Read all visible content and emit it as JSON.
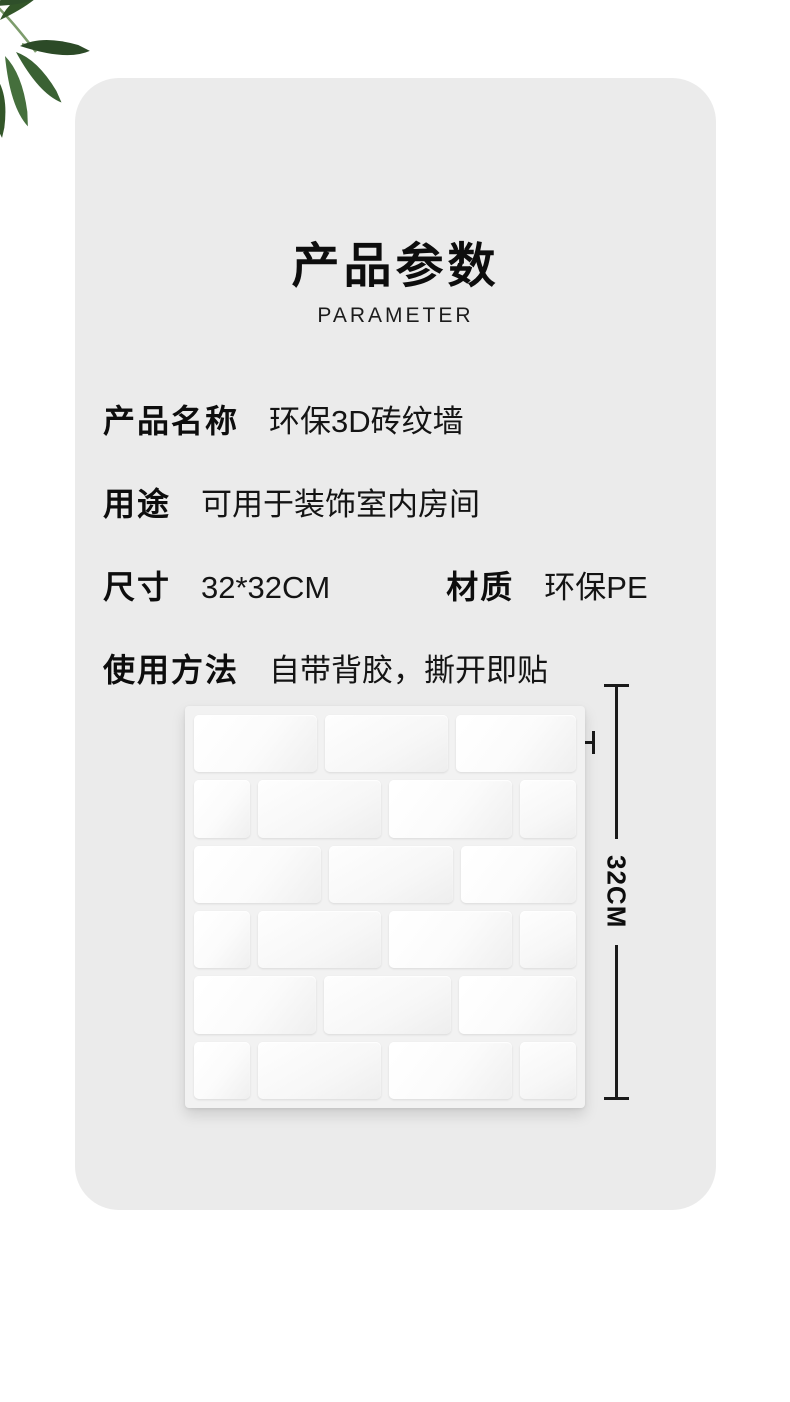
{
  "header": {
    "title": "产品参数",
    "subtitle": "PARAMETER"
  },
  "specs": {
    "rows": [
      {
        "pairs": [
          {
            "label": "产品名称",
            "value": "环保3D砖纹墙"
          }
        ]
      },
      {
        "pairs": [
          {
            "label": "用途",
            "value": "可用于装饰室内房间"
          }
        ]
      },
      {
        "pairs": [
          {
            "label": "尺寸",
            "value": "32*32CM"
          },
          {
            "label": "材质",
            "value": "环保PE"
          }
        ]
      },
      {
        "pairs": [
          {
            "label": "使用方法",
            "value": "自带背胶，撕开即贴"
          }
        ]
      }
    ]
  },
  "diagram": {
    "width_label": "32CM",
    "height_label": "32CM",
    "panel_description": "white 3D brick texture wall panel",
    "brick_rows": [
      {
        "widths": [
          1,
          1,
          0.97
        ]
      },
      {
        "widths": [
          0.45,
          1,
          1,
          0.45
        ]
      },
      {
        "widths": [
          1.05,
          1.02,
          0.95
        ]
      },
      {
        "widths": [
          0.45,
          1,
          1,
          0.45
        ]
      },
      {
        "widths": [
          1,
          1.04,
          0.96
        ]
      },
      {
        "widths": [
          0.45,
          1,
          1,
          0.45
        ]
      }
    ]
  },
  "colors": {
    "card_background": "#ebebeb",
    "page_background": "#ffffff",
    "text": "#111111",
    "dimension_line": "#1a1a1a",
    "brick_white": "#fdfdfd",
    "leaf_green_dark": "#2f4f2a",
    "leaf_green_mid": "#3a6133",
    "leaf_green_light": "#456f3c"
  }
}
